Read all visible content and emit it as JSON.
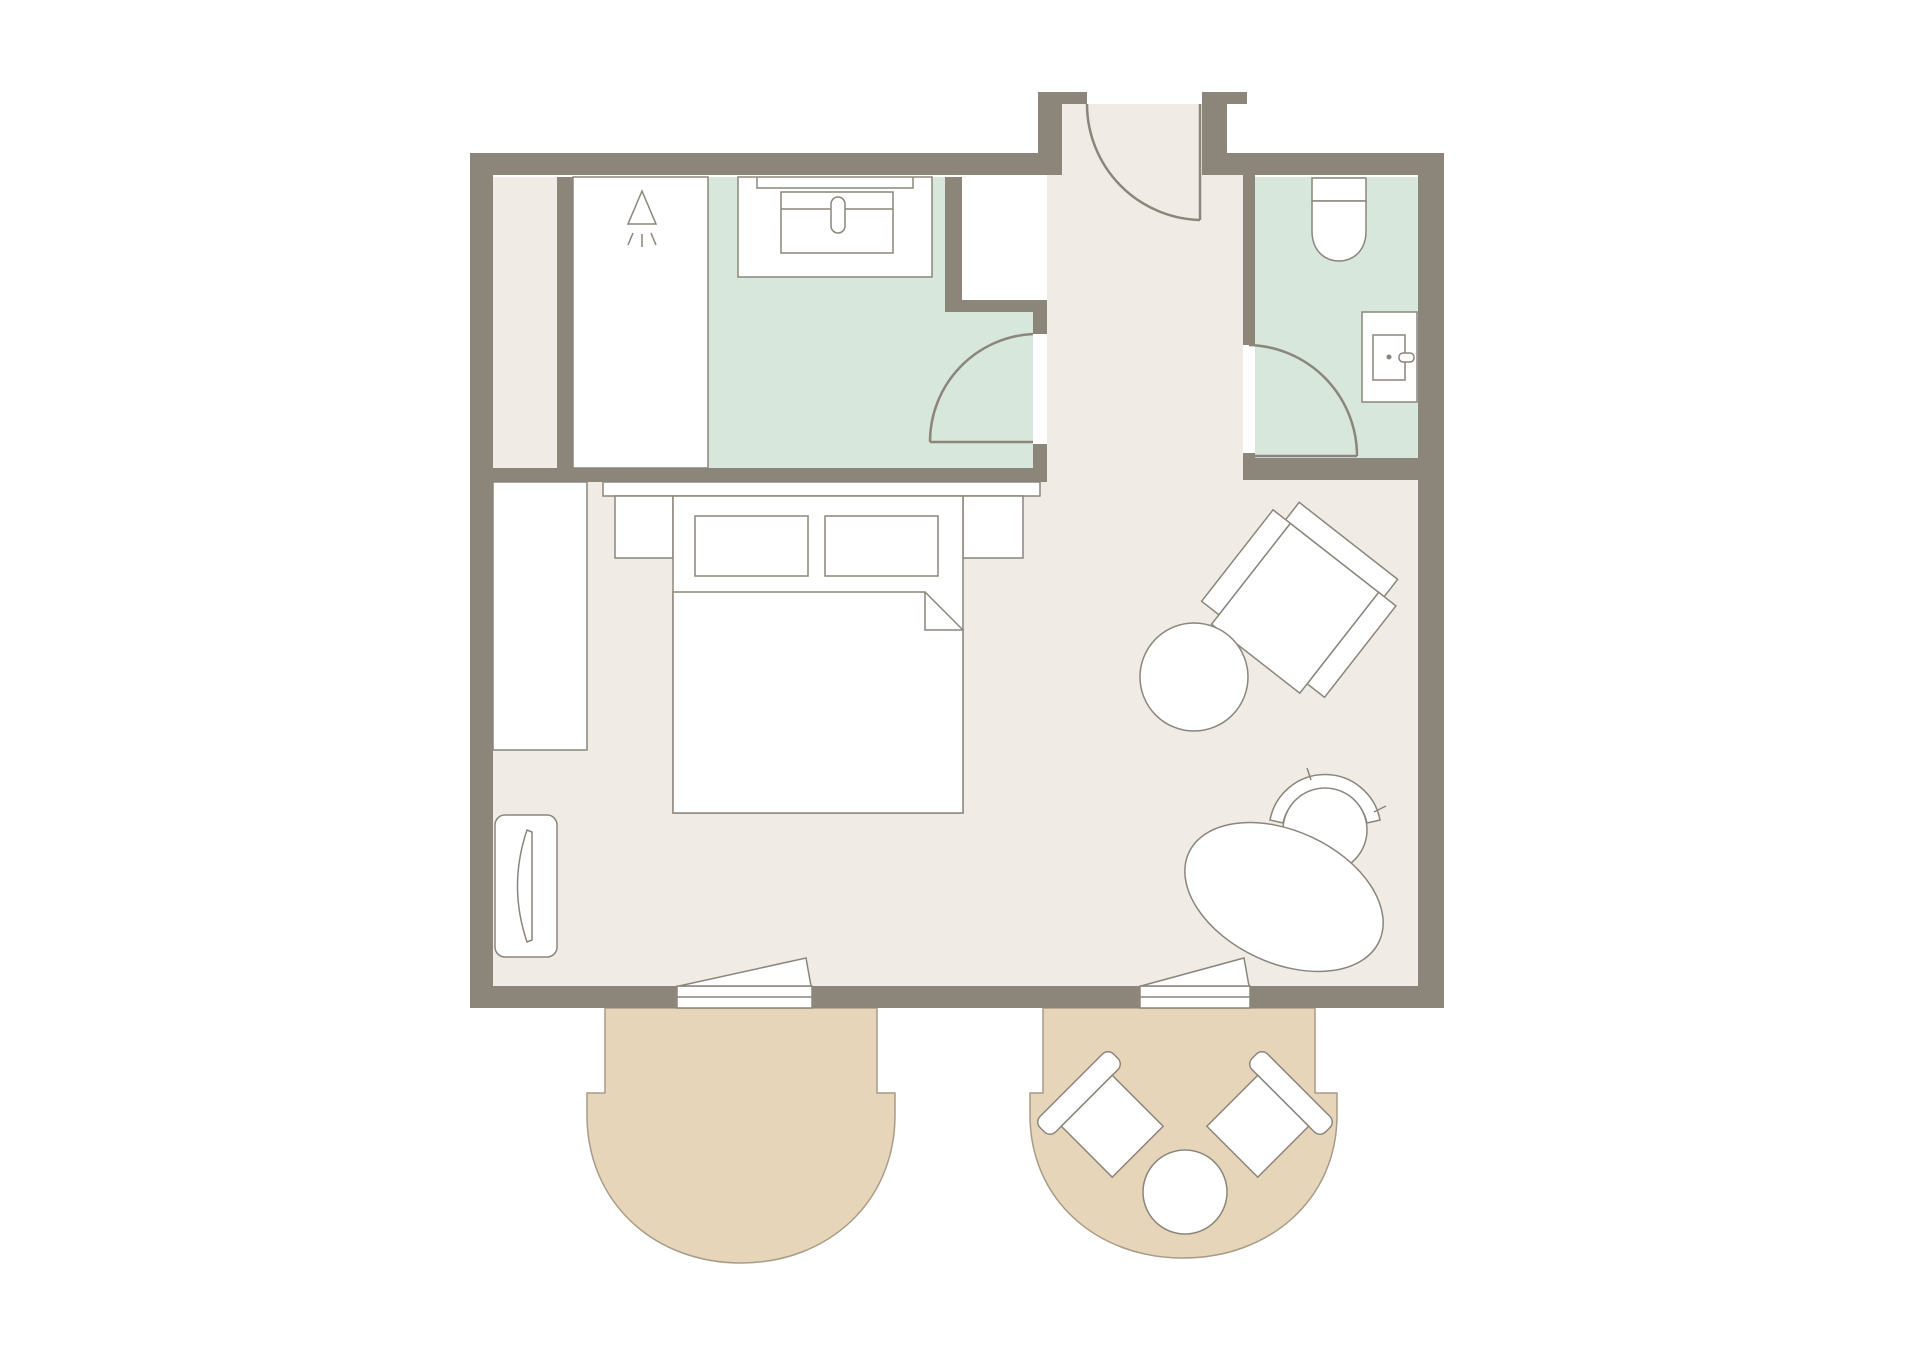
{
  "title": "apartment-floor-plan",
  "colors": {
    "background": "#ffffff",
    "wall": "#8c867a",
    "floor": "#f0ebe5",
    "wet_floor": "#d8e7dc",
    "balcony_floor": "#e6d5b8",
    "balcony_outline": "#a79c88",
    "furniture": "#ffffff",
    "outline": "#8b867c"
  },
  "plan": {
    "rooms": [
      {
        "name": "entry-vestibule",
        "floor_color_key": "floor"
      },
      {
        "name": "hallway",
        "floor_color_key": "floor"
      },
      {
        "name": "shower-room",
        "floor_color_key": "wet_floor"
      },
      {
        "name": "bathroom",
        "floor_color_key": "wet_floor"
      },
      {
        "name": "bedroom",
        "floor_color_key": "floor"
      },
      {
        "name": "sitting-area",
        "floor_color_key": "floor"
      },
      {
        "name": "storage-niche",
        "floor_color_key": "floor"
      },
      {
        "name": "closet-nook",
        "floor_color_key": "furniture"
      },
      {
        "name": "balcony-left",
        "floor_color_key": "balcony_floor"
      },
      {
        "name": "balcony-right",
        "floor_color_key": "balcony_floor"
      }
    ],
    "doors": [
      "entry-door",
      "shower-room-door",
      "bathroom-door"
    ],
    "windows": [
      "bedroom-window",
      "sitting-area-window"
    ],
    "furniture": {
      "bedroom": [
        "sideboard",
        "luggage-rack",
        "headboard",
        "nightstand-left",
        "nightstand-right",
        "double-bed",
        "pillow-left",
        "pillow-right",
        "duvet-with-folded-corner"
      ],
      "shower_room": [
        "shower-stall",
        "shower-head-symbol",
        "vanity-washbasin",
        "faucet"
      ],
      "bathroom": [
        "toilet",
        "washbasin",
        "faucet"
      ],
      "sitting_area": [
        "armchair",
        "round-side-table",
        "oval-desk",
        "desk-chair"
      ],
      "balcony_right": [
        "outdoor-chair-left",
        "outdoor-chair-right",
        "outdoor-round-table"
      ]
    }
  }
}
